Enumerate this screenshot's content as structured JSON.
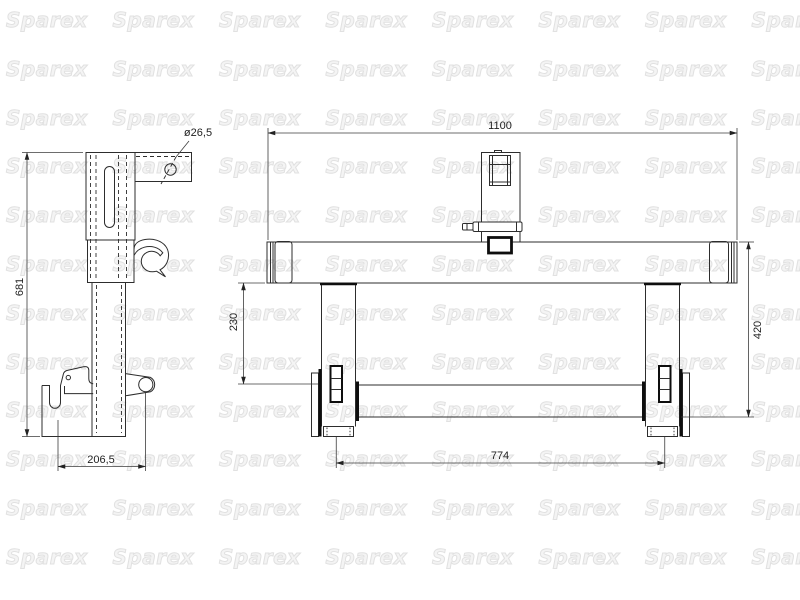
{
  "watermark": {
    "text": "Sparex"
  },
  "colors": {
    "background": "#ffffff",
    "line": "#2d2d2d",
    "thick_line": "#0e0e0e",
    "watermark": "#e1e1e1"
  },
  "side_view": {
    "description": "post-with-hook-side-view",
    "dims": {
      "post_height": "681",
      "catch_width": "206,5",
      "hole_diameter": "ø26,5"
    }
  },
  "front_view": {
    "description": "frame-front-view",
    "dims": {
      "beam_length": "1100",
      "frame_height": "420",
      "beam_to_bar": "230",
      "bar_spacing": "774"
    }
  }
}
